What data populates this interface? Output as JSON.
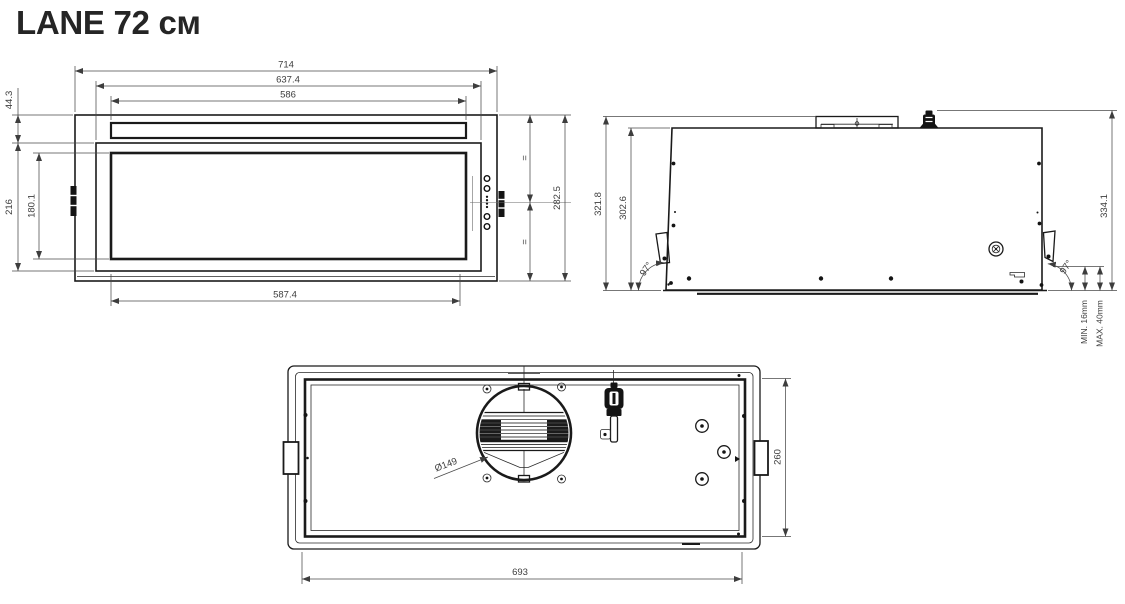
{
  "title": "LANE 72 см",
  "front_view": {
    "overall_width": "714",
    "panel_width": "637.4",
    "glass_width": "586",
    "top_section_height": "44.3",
    "panel_height": "216",
    "glass_height": "180.1",
    "overall_height": "282.5",
    "bottom_opening_width": "587.4",
    "equal_mark_top": "=",
    "equal_mark_bottom": "="
  },
  "side_view": {
    "front_height": "321.8",
    "body_height": "302.6",
    "rear_height": "334.1",
    "front_angle": "97°",
    "rear_angle": "97°",
    "panel_thickness_min": "MIN. 16mm",
    "panel_thickness_max": "MAX. 40mm"
  },
  "bottom_view": {
    "duct_diameter": "Ø149",
    "opening_width": "693",
    "opening_depth": "260"
  }
}
